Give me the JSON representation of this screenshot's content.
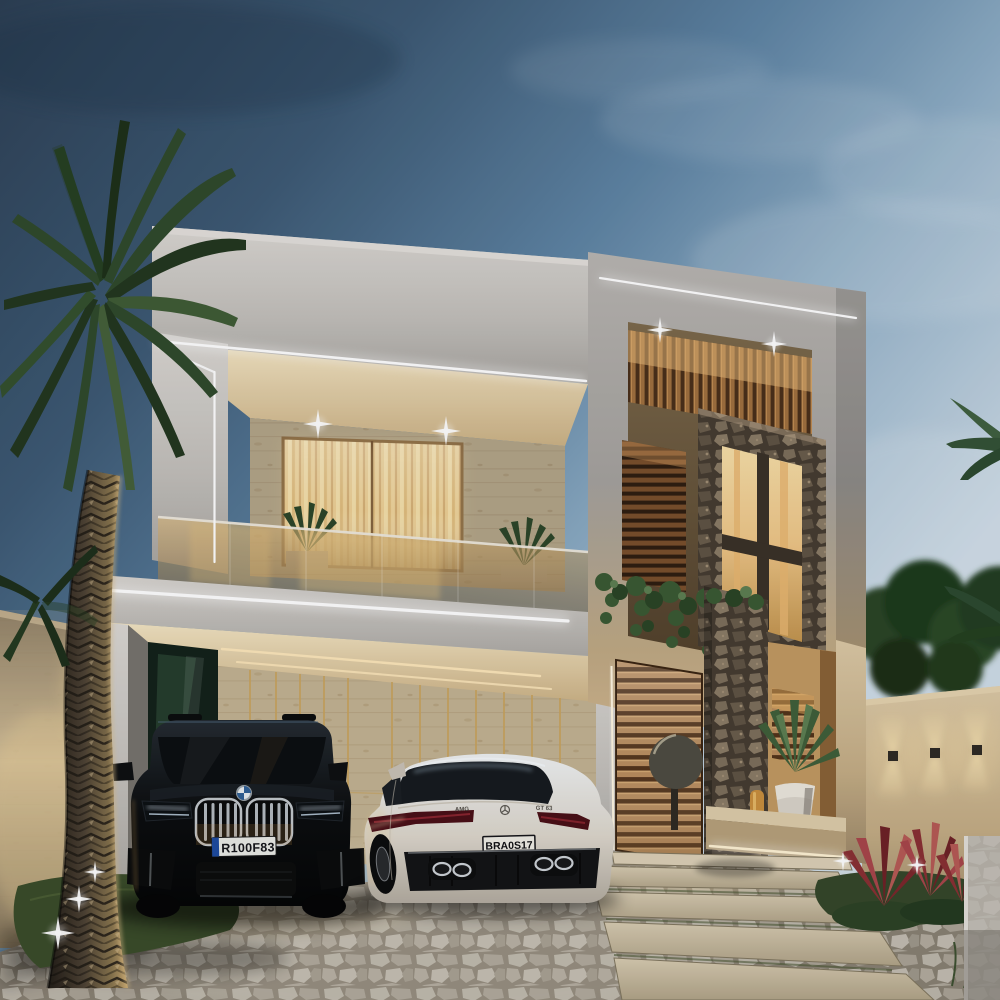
{
  "scene": {
    "setting": "modern two-story luxury house exterior at dusk",
    "vehicles_present": 2
  },
  "vehicles": {
    "suv": {
      "body_color": "black",
      "license_plate": "R100F83"
    },
    "coupe": {
      "body_color": "white",
      "license_plate": "BRA0S17",
      "badge_left": "AMG",
      "badge_right": "GT 63"
    }
  },
  "palette": {
    "sky_top": "#2c3f54",
    "sky_mid": "#5f85a5",
    "sky_light": "#cfdde8",
    "concrete": "#c9c6c1",
    "travertine": "#cdbfa4",
    "wood": "#a9713f",
    "warm_glow": "#f2dfae",
    "led": "#ffffff",
    "foliage": "#2f4a2c",
    "stone": "#5d5246",
    "cobble": "#b3ada1",
    "red_plant": "#a64448",
    "beige_wall": "#d9c7a3"
  }
}
